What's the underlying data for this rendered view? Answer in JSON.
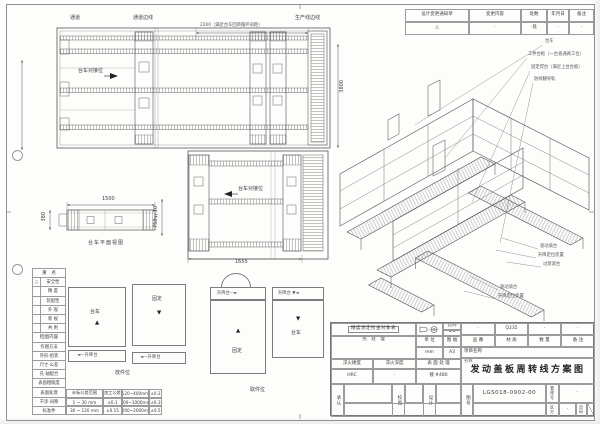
{
  "revision_table": {
    "headers": [
      "设计变更通知单",
      "变更内容",
      "处数",
      "年月日",
      "备注"
    ],
    "values": [
      "△",
      "·",
      "·处",
      "·",
      "·"
    ]
  },
  "plan_top": {
    "corridor": "通道",
    "corridor_edge": "通道边线",
    "dim_2200": "2200（满足台车回转循环间距）",
    "production_edge": "生产线边线",
    "dock": "台车对接位",
    "dim_3800": "3800"
  },
  "plan_lower": {
    "dock": "台车对接位",
    "dim_1655": "1655"
  },
  "side_view": {
    "dim_1500": "1500",
    "dim_380": "380",
    "dim_750": "750±10",
    "caption": "台车平面视图"
  },
  "iso": {
    "callouts_top": [
      "台车",
      "工件台板（一台直通两工位）",
      "固定焊台（满足上台台板）",
      "防倾翻导轨"
    ],
    "callouts_right": [
      "驱动滚台",
      "升降定位装置",
      "过渡滚台"
    ],
    "callouts_left": [
      "驱动滚台",
      "升降定位装置"
    ]
  },
  "details": {
    "box_a": "台车",
    "strip_a": "◄—升降台",
    "box_b": "固定",
    "strip_b": "◄—升降台",
    "strip_c": "升降台—►",
    "box_c": "固定",
    "strip_d": "升降台 ▼◄",
    "box_d": "台车",
    "caption_left": "放件位",
    "caption_right": "取件位",
    "arrow_up": "▲",
    "arrow_down": "▼"
  },
  "checklist": {
    "title": "重　点",
    "items": [
      {
        "mark": "○",
        "label": "安全性"
      },
      {
        "mark": "",
        "label": "精 度"
      },
      {
        "mark": "",
        "label": "装配性"
      },
      {
        "mark": "",
        "label": "外 观"
      },
      {
        "mark": "",
        "label": "新 规"
      },
      {
        "mark": "",
        "label": "共 用"
      }
    ],
    "section2": "检图内容",
    "items2": [
      "作图方法",
      "外形·组装",
      "尺寸·公差",
      "孔·轴配合",
      "表面粗糙度",
      "表面处理",
      "干涉·间隙",
      "标准件"
    ]
  },
  "tolerance": {
    "rows": [
      [
        "未标公差范围",
        "加工公差",
        "120~400mm",
        "±0.2"
      ],
      [
        "1 ~ 30 mm",
        "±0.1",
        "400~1000mm",
        "±0.3"
      ],
      [
        "30 ~ 120 mm",
        "±0.15",
        "1000~2000mm",
        "±0.5"
      ]
    ]
  },
  "title_block": {
    "check_box": "精度测定检查对象表",
    "scale_label": "比例",
    "scale_value": "1/5",
    "unit_label": "单 位",
    "unit_value": "mm",
    "format_label": "图 幅",
    "format_value": "A3",
    "heat_label": "热　处　理",
    "hardness_label": "淬火硬度",
    "hardness_value": "HRC",
    "depth_label": "淬火深度",
    "depth_value": "·",
    "surface_label": "表 面 处 理",
    "surface_value": "镀 #480",
    "part_no_label": "品 番",
    "part_no_value": "·",
    "material_label": "材 质",
    "material_value": "Q235",
    "qty_label": "数 量",
    "qty_value": "·",
    "remark_label": "备 注",
    "remark_value": "·",
    "project_label": "项目名称",
    "name_label": "名称",
    "name_value": "发动盖板周转线方案图",
    "approve_label": "承认",
    "check_label": "校图",
    "design_label": "设计",
    "design_dot": "·",
    "drawing_no_label": "图号",
    "drawing_no_value": "LGS018-0902-00",
    "manage_label": "管理号",
    "manage_value": "·",
    "class_label": "区分",
    "class_value": "·",
    "page_label": "页码"
  }
}
